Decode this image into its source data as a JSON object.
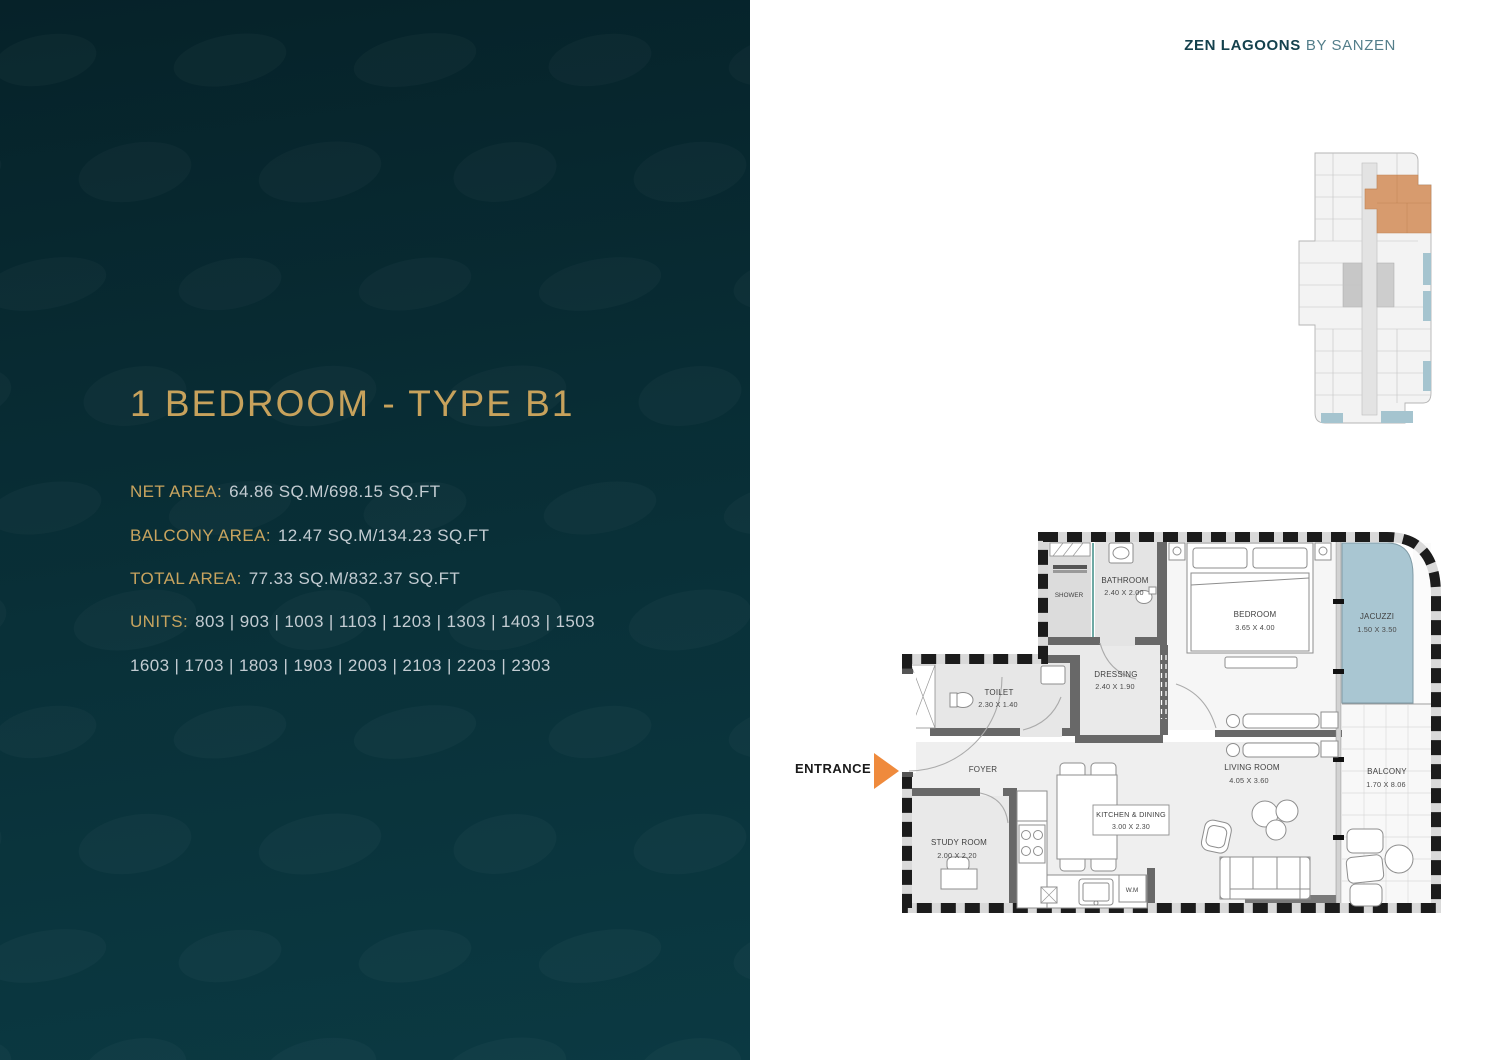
{
  "panel": {
    "title": "1 BEDROOM - TYPE B1",
    "stats": [
      {
        "label": "NET AREA:",
        "value": "64.86 SQ.M/698.15 SQ.FT"
      },
      {
        "label": "BALCONY AREA:",
        "value": "12.47 SQ.M/134.23 SQ.FT"
      },
      {
        "label": "TOTAL AREA:",
        "value": "77.33 SQ.M/832.37 SQ.FT"
      },
      {
        "label": "UNITS:",
        "value": "803 | 903 | 1003 | 1103 | 1203 | 1303 | 1403 | 1503"
      }
    ],
    "units_line2": "1603 | 1703 | 1803 | 1903 | 2003 | 2103 | 2203 | 2303"
  },
  "header": {
    "brand": "ZEN LAGOONS",
    "byline": "BY SANZEN"
  },
  "entrance": {
    "label": "ENTRANCE"
  },
  "floorplan": {
    "rooms": {
      "shower": {
        "name": "SHOWER"
      },
      "bathroom": {
        "name": "BATHROOM",
        "dims": "2.40 X 2.00"
      },
      "bedroom": {
        "name": "BEDROOM",
        "dims": "3.65 X 4.00"
      },
      "jacuzzi": {
        "name": "JACUZZI",
        "dims": "1.50 X 3.50"
      },
      "toilet": {
        "name": "TOILET",
        "dims": "2.30 X 1.40"
      },
      "dressing": {
        "name": "DRESSING",
        "dims": "2.40 X 1.90"
      },
      "foyer": {
        "name": "FOYER"
      },
      "living": {
        "name": "LIVING ROOM",
        "dims": "4.05 X 3.60"
      },
      "balcony": {
        "name": "BALCONY",
        "dims": "1.70 X 8.06"
      },
      "study": {
        "name": "STUDY ROOM",
        "dims": "2.00 X 2.20"
      },
      "kitchen": {
        "name": "KITCHEN & DINING",
        "dims": "3.00 X 2.30"
      },
      "wm": {
        "name": "W.M"
      }
    }
  },
  "colors": {
    "gold": "#c8a45f",
    "panel_bg": "#0a343d",
    "value_text": "#c3ccd2",
    "brand_teal": "#14414d",
    "entrance_orange": "#ef8a3c",
    "jacuzzi_blue": "#a9c6d2",
    "keyplan_highlight": "#d79b6e",
    "keyplan_blue": "#a5c4cf"
  }
}
